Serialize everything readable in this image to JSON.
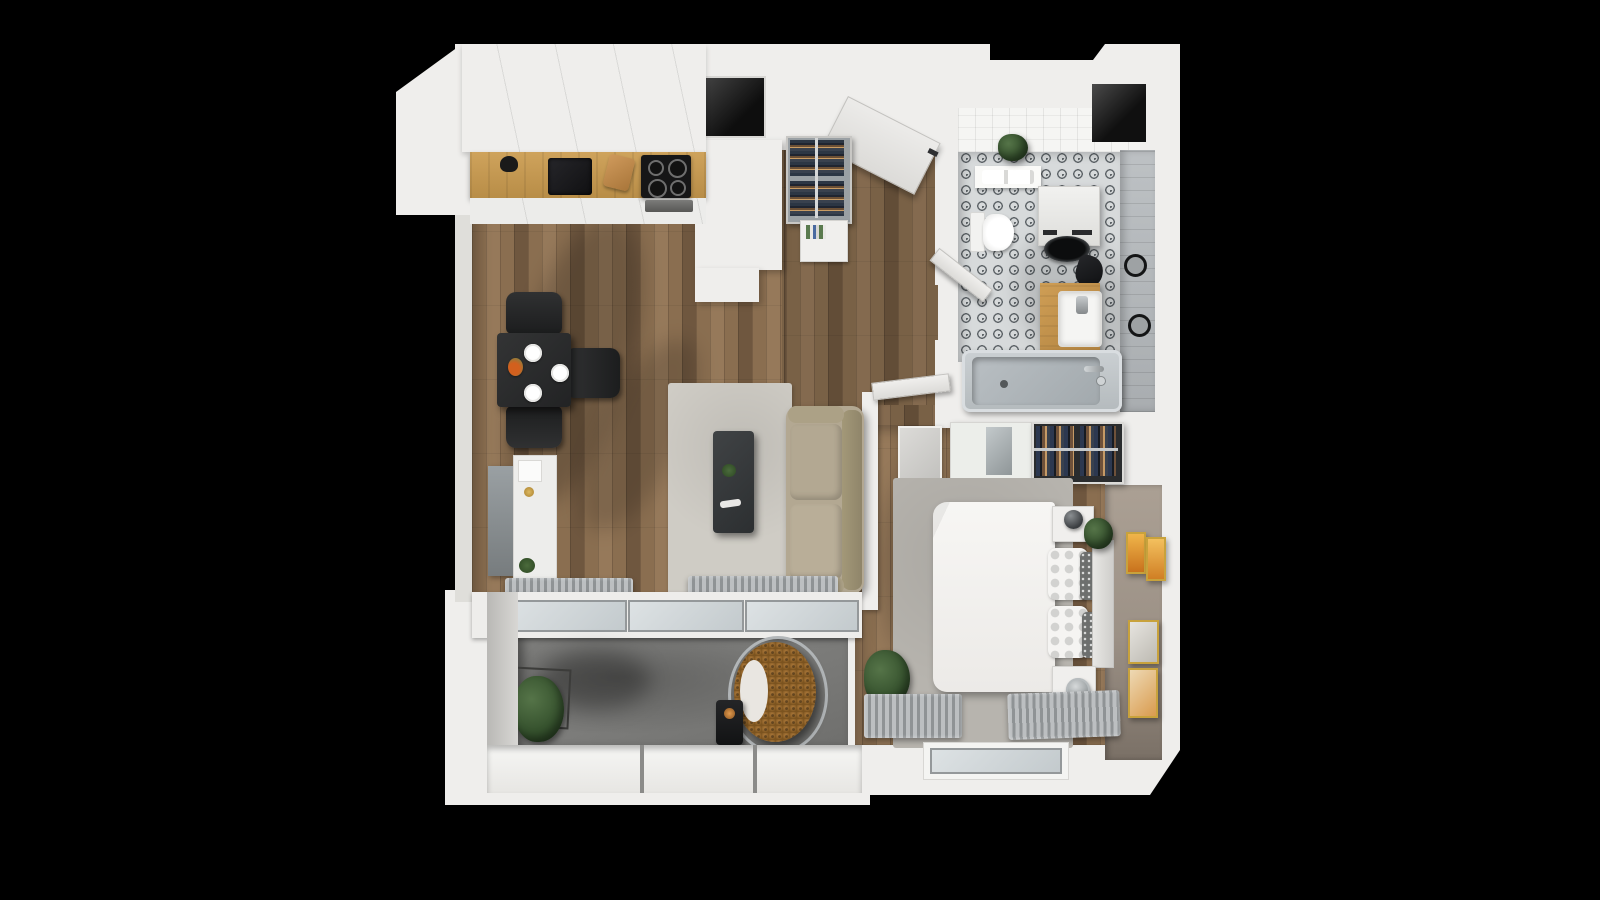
{
  "scene": {
    "title": "apartment-3d-floor-plan-top-view",
    "style": "isometric top-down 3D architectural render on black background",
    "background_color": "#000000"
  },
  "palette": {
    "bg": "#000000",
    "wall": "#efeeec",
    "wallShade": "#dfdeda",
    "wood": "#8a6e50",
    "woodLight": "#96795a",
    "woodDark": "#6f573f",
    "counter": "#c49b55",
    "rug": "#cfccc5",
    "rugBed": "#b7b4ae",
    "sofa": "#b3a892",
    "sofaDark": "#a39878",
    "tableDark": "#2b2c2d",
    "charcoal": "#232425",
    "tileBase": "#d7dadb",
    "tileDark": "#5f6569",
    "grayTile": "#b6babc",
    "taupe": "#a2978b",
    "taupeDark": "#71675d",
    "concrete": "#7d7d7b",
    "parapet": "#f3f3f1",
    "glass": "#ccd2d5",
    "radiator": "#bcbfc1",
    "radiatorDark": "#8f9395",
    "plant": "#3e5c38",
    "rattan": "#9a6a33",
    "gold": "#c8a23c",
    "art": "#e08a2e",
    "white": "#f5f4f2",
    "steel": "#9aa0a2",
    "dark": "#1b1c1e",
    "vanity": "#c2954f",
    "tub": "#c3c8cb",
    "tubInner": "#aeb4b8",
    "pillowGray": "#6d6f6e"
  },
  "rooms": {
    "kitchen": {
      "floor": "wood-planks",
      "items": [
        "upper-cabinets",
        "oak-countertop",
        "black-sink",
        "faucet",
        "cutting-board",
        "induction-cooktop",
        "oven",
        "tall-cabinet-column",
        "wall-niche"
      ]
    },
    "dining_area": {
      "floor": "wood-planks",
      "items": [
        "black-dining-table",
        "three-plates",
        "flower-centerpiece",
        "chair-top",
        "chair-right",
        "chair-bottom"
      ]
    },
    "living_room": {
      "floor": "wood-planks",
      "items": [
        "light-gray-area-rug",
        "dark-coffee-table",
        "beige-sofa",
        "tv-sideboard",
        "radiator-left",
        "radiator-center",
        "glass-balcony-doors"
      ]
    },
    "hallway": {
      "floor": "wood-planks",
      "items": [
        "entrance-door-open",
        "coat-rack-with-clothes",
        "shoe-shelf-with-books",
        "bedroom-door-open",
        "bathroom-door-open"
      ]
    },
    "bathroom": {
      "floor": "patterned-cement-tile",
      "walls": [
        "white-tile",
        "gray-tile"
      ],
      "items": [
        "toilet",
        "washing-machine",
        "laundry-bag",
        "wood-vanity-with-sink",
        "bathtub-with-faucet",
        "towel-rings",
        "wall-shelf-with-plant",
        "towels",
        "vent-shaft"
      ]
    },
    "bedroom": {
      "floor": "wood-planks",
      "items": [
        "double-bed-white-duvet",
        "quilted-pillows",
        "gray-dot-pillows",
        "headboard",
        "gray-rug",
        "nightstand-top-with-lamp",
        "nightstand-bottom-with-lamp",
        "bedside-plant",
        "mirror-wardrobe-cabinet",
        "open-closet-hanging-clothes",
        "small-gray-cabinet",
        "gold-wall-frames",
        "corner-plant",
        "radiator-left",
        "radiator-right",
        "window"
      ]
    },
    "balcony": {
      "floor": "concrete",
      "items": [
        "white-parapet",
        "potted-plant-in-wire-stand",
        "hanging-egg-chair",
        "black-lantern"
      ]
    }
  }
}
